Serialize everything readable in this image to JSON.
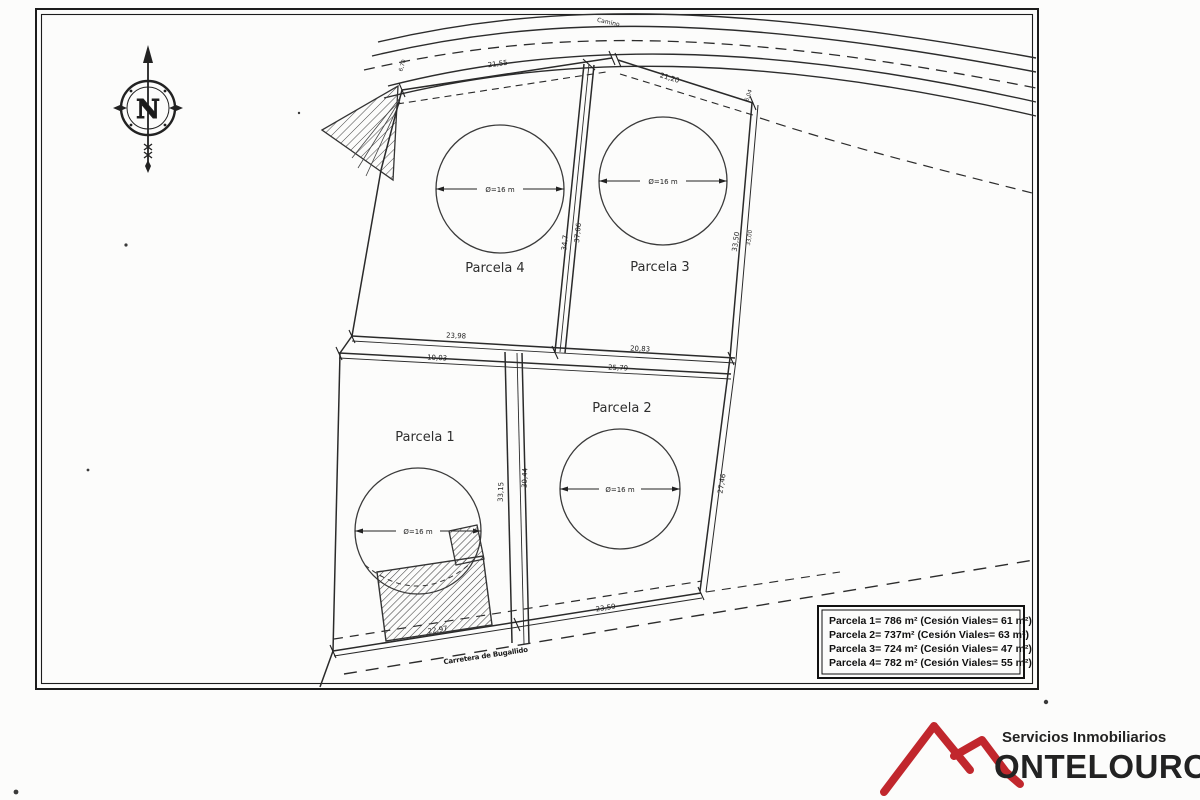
{
  "compass": {
    "north_label": "N"
  },
  "parcels": {
    "p1": {
      "name": "Parcela 1",
      "diameter": "Ø=16 m"
    },
    "p2": {
      "name": "Parcela 2",
      "diameter": "Ø=16 m"
    },
    "p3": {
      "name": "Parcela 3",
      "diameter": "Ø=16 m"
    },
    "p4": {
      "name": "Parcela 4",
      "diameter": "Ø=16 m"
    }
  },
  "roads": {
    "top": "Camino",
    "bottom": "Carretera de Bugallido"
  },
  "dims": {
    "p4_top": "21,55",
    "p3_top": "21,20",
    "corner_left": "6,70",
    "corner_right": "6,04",
    "mid_road_a": "34,7",
    "mid_road_b": "37,06",
    "right_upper_a": "33,50",
    "right_upper_b": "33,00",
    "div_top_left": "23,98",
    "div_top_right": "20,83",
    "div_bottom_left": "10,03",
    "div_bottom_right": "25,79",
    "lower_road_a": "33,15",
    "lower_road_b": "30,44",
    "right_lower": "27,46",
    "bottom_left": "22,97",
    "bottom_right": "23,59"
  },
  "legend": {
    "line1": "Parcela 1= 786 m² (Cesión Viales= 61 m²)",
    "line2": "Parcela 2= 737m² (Cesión Viales= 63 m²)",
    "line3": "Parcela 3= 724 m² (Cesión Viales= 47 m²)",
    "line4": "Parcela 4= 782 m² (Cesión Viales= 55 m²)"
  },
  "logo": {
    "tagline": "Servicios Inmobiliarios",
    "brand": "ONTELOURO",
    "brand_color": "#c1272d"
  }
}
